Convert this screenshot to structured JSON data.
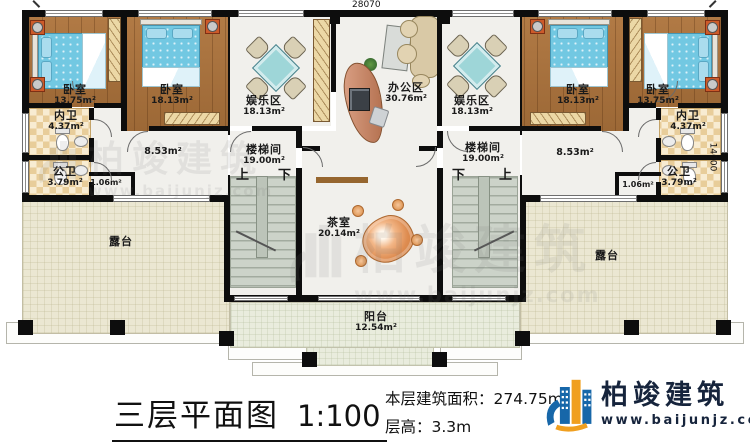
{
  "title_block": {
    "title": "三层平面图",
    "scale": "1:100",
    "area_label": "本层建筑面积：",
    "area_value": "274.75m²",
    "floor_height_label": "层高：",
    "floor_height_value": "3.3m"
  },
  "logo": {
    "name": "柏竣建筑",
    "website": "www.baijunjz.com"
  },
  "watermark": {
    "name": "柏竣建筑",
    "website": "www.baijunjz.com"
  },
  "dimensions": {
    "top": "28070",
    "right": "14000"
  },
  "stairs": {
    "up": "上",
    "down": "下"
  },
  "rooms": {
    "bedroom_l1": {
      "name": "卧室",
      "area": "13.75m²"
    },
    "bedroom_l2": {
      "name": "卧室",
      "area": "18.13m²"
    },
    "bath_private_l": {
      "name": "内卫",
      "area": "4.37m²"
    },
    "bath_public_l": {
      "name": "公卫",
      "area": "3.79m²"
    },
    "hall_l_area": "8.53m²",
    "closet_l_area": "1.06m²",
    "entertainment_l": {
      "name": "娱乐区",
      "area": "18.13m²"
    },
    "stairwell_l": {
      "name": "楼梯间",
      "area": "19.00m²"
    },
    "office": {
      "name": "办公区",
      "area": "30.76m²"
    },
    "tea_room": {
      "name": "茶室",
      "area": "20.14m²"
    },
    "entertainment_r": {
      "name": "娱乐区",
      "area": "18.13m²"
    },
    "stairwell_r": {
      "name": "楼梯间",
      "area": "19.00m²"
    },
    "bedroom_r1": {
      "name": "卧室",
      "area": "18.13m²"
    },
    "bedroom_r2": {
      "name": "卧室",
      "area": "13.75m²"
    },
    "bath_private_r": {
      "name": "内卫",
      "area": "4.37m²"
    },
    "bath_public_r": {
      "name": "公卫",
      "area": "3.79m²"
    },
    "hall_r_area": "8.53m²",
    "closet_r_area": "1.06m²",
    "terrace_l": {
      "name": "露台"
    },
    "balcony": {
      "name": "阳台",
      "area": "12.54m²"
    },
    "terrace_r": {
      "name": "露台"
    }
  },
  "colors": {
    "wall": "#0d0d0d",
    "wood_floor": "#a9713c",
    "bed": "#72c8e2",
    "bath_tile": "#e8cd9a",
    "terrace": "#ebe7d2",
    "stair": "#ccd3c9",
    "brand_blue": "#1767a9",
    "brand_orange": "#f09f1f",
    "brand_navy": "#16243c"
  }
}
